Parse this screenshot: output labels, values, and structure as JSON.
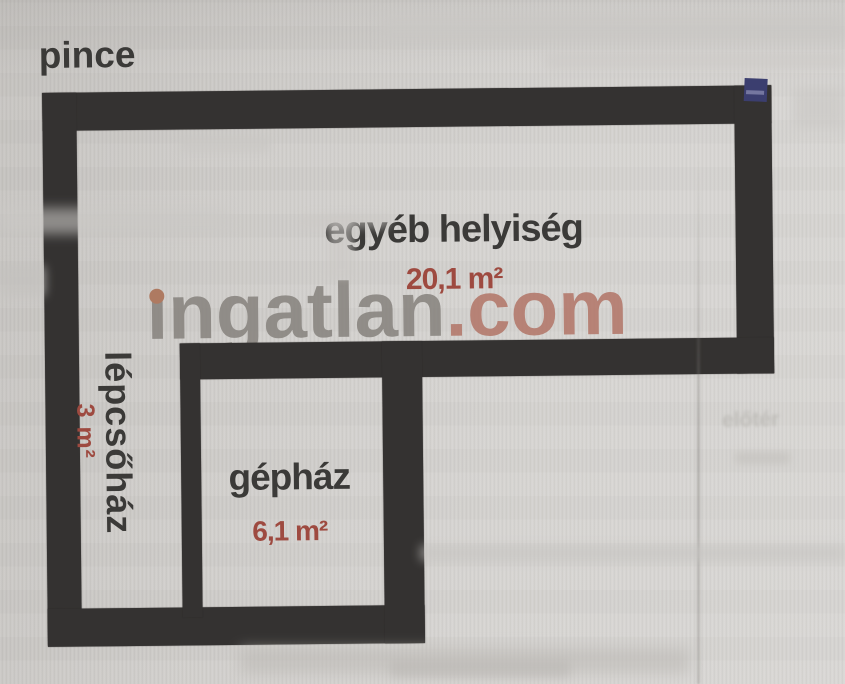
{
  "title": "pince",
  "rooms": [
    {
      "name": "egyéb helyiség",
      "area": "20,1 m²"
    },
    {
      "name": "lépcsőház",
      "area": "3 m²"
    },
    {
      "name": "gépház",
      "area": "6,1 m²"
    }
  ],
  "watermark": {
    "gray_text": "ingatlan",
    "red_text": ".com"
  },
  "ghost_labels": {
    "eloter": "előtér"
  },
  "colors": {
    "wall": "#343231",
    "paper": "#d4d2cf",
    "room_label": "#3b3a38",
    "area_label": "#9e4a40",
    "watermark_gray": "#86827d",
    "watermark_red": "#b27567",
    "watermark_dot": "#ae7a61",
    "corner_sticker": "#3b3e6f"
  }
}
